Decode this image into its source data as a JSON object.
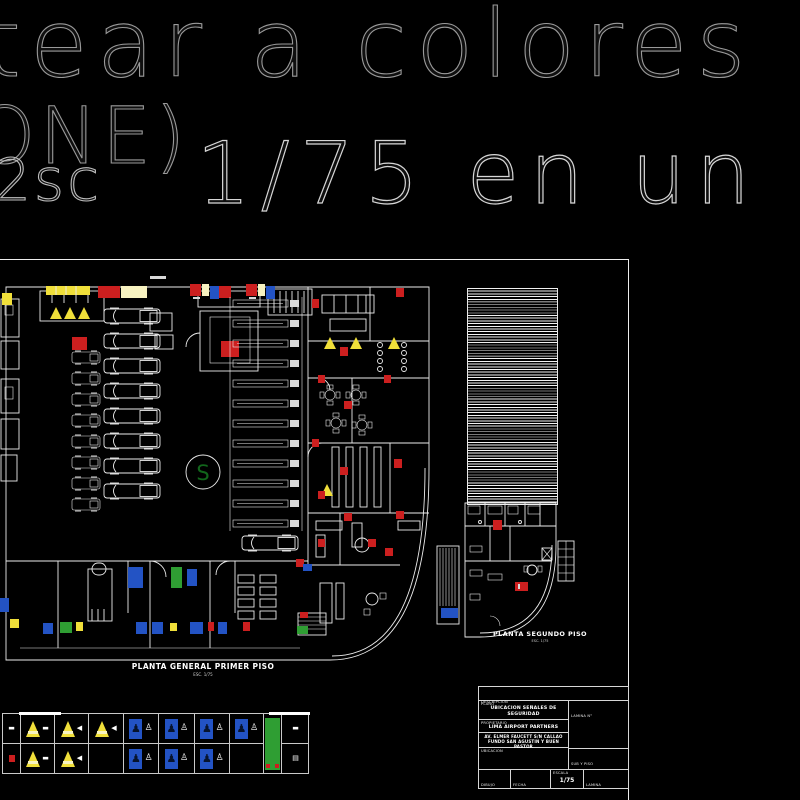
{
  "colors": {
    "bg": "#000000",
    "line": "#ececec",
    "red": "#cc1f1f",
    "blue": "#2353c4",
    "yellow": "#f0df3a",
    "paleyellow": "#f7f2c0",
    "green": "#2f9e33",
    "darkgreen": "#11661b",
    "outline_text": "#9a9a9a"
  },
  "overlay_text": {
    "line1": "tear a colores",
    "line2_big": "ONE)",
    "line2_small": "2sc",
    "line2_rest": "1/75 en un"
  },
  "first_floor": {
    "title": "PLANTA GENERAL PRIMER PISO",
    "scale_note": "ESC. 1/75",
    "ramp_letter": "S"
  },
  "second_floor": {
    "title": "PLANTA SEGUNDO PISO",
    "scale_note": "ESC. 1/75"
  },
  "legend": {
    "columns": [
      {
        "w": 18,
        "r1": {
          "g": "dash"
        },
        "r2": {
          "g": "reddot"
        }
      },
      {
        "w": 34,
        "r1": {
          "s": "cone",
          "g": "dash"
        },
        "r2": {
          "s": "cone",
          "g": "dash"
        }
      },
      {
        "w": 34,
        "r1": {
          "s": "cone",
          "g": "arrow"
        },
        "r2": {
          "s": "cone",
          "g": "arrow"
        }
      },
      {
        "w": 35,
        "r1": {
          "s": "cone",
          "g": "arrow"
        },
        "r2": {}
      },
      {
        "w": 35,
        "r1": {
          "s": "blue",
          "g": "person"
        },
        "r2": {
          "s": "blue",
          "g": "person"
        }
      },
      {
        "w": 36,
        "r1": {
          "s": "blue",
          "g": "person"
        },
        "r2": {
          "s": "blue",
          "g": "person"
        }
      },
      {
        "w": 35,
        "r1": {
          "s": "blue",
          "g": "person"
        },
        "r2": {
          "s": "blue",
          "g": "person"
        }
      },
      {
        "w": 34,
        "r1": {
          "s": "blue",
          "g": "person"
        },
        "r2": {}
      },
      {
        "w": 18,
        "type": "green"
      },
      {
        "w": 27,
        "r1": {
          "g": "dash"
        },
        "r2": {
          "g": "steps"
        }
      }
    ]
  },
  "title_block": {
    "descripcion_label": "DESCRIPCION",
    "plano_label": "PLANO",
    "plano_value": "UBICACION SEÑALES DE SEGURIDAD",
    "lamina_n_label": "LAMINA N°",
    "propietario_label": "PROPIETARIO",
    "propietario_value": "LIMA AIRPORT PARTNERS",
    "direccion_label": "DIRECCION",
    "direccion_line1": "AV. ELMER FAUCETT S/N CALLAO",
    "direccion_line2": "FUNDO SAN AGUSTIN Y BUEN PASTOR",
    "ubicacion_label": "UBICACION",
    "sector_value": "SUB Y PISO",
    "dibujo_label": "DIBUJO",
    "fecha_label": "FECHA",
    "escala_label": "ESCALA",
    "escala_value": "1/75",
    "lamina_label": "LAMINA"
  }
}
